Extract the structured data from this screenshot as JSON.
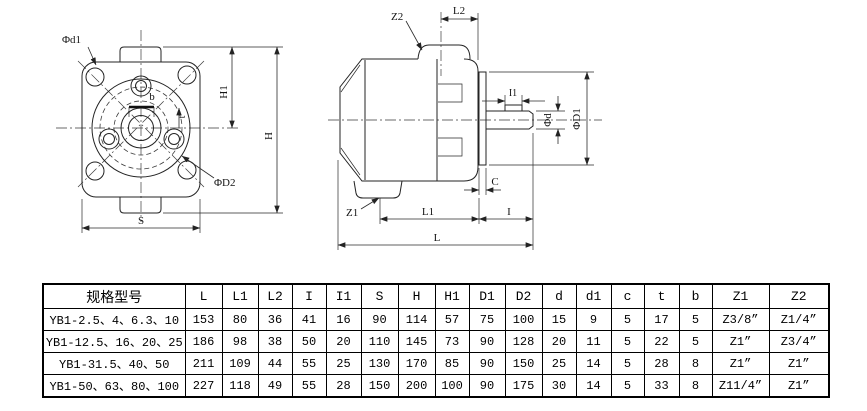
{
  "colors": {
    "line": "#232323",
    "text": "#141414",
    "table_border": "#000000",
    "background": "#ffffff"
  },
  "front_view": {
    "labels": {
      "phi_d1": "Φd1",
      "b": "b",
      "t": "t",
      "h1": "H1",
      "h": "H",
      "phi_d2": "ΦD2",
      "s": "S"
    }
  },
  "side_view": {
    "labels": {
      "z2": "Z2",
      "l2": "L2",
      "i1": "I1",
      "phi_d": "Φd",
      "phi_d1": "ΦD1",
      "c": "C",
      "z1": "Z1",
      "l1": "L1",
      "i": "I",
      "l": "L"
    }
  },
  "table": {
    "headers": [
      "规格型号",
      "L",
      "L1",
      "L2",
      "I",
      "I1",
      "S",
      "H",
      "H1",
      "D1",
      "D2",
      "d",
      "d1",
      "c",
      "t",
      "b",
      "Z1",
      "Z2"
    ],
    "rows": [
      [
        "YB1-2.5、4、6.3、10",
        "153",
        "80",
        "36",
        "41",
        "16",
        "90",
        "114",
        "57",
        "75",
        "100",
        "15",
        "9",
        "5",
        "17",
        "5",
        "Z3/8”",
        "Z1/4”"
      ],
      [
        "YB1-12.5、16、20、25",
        "186",
        "98",
        "38",
        "50",
        "20",
        "110",
        "145",
        "73",
        "90",
        "128",
        "20",
        "11",
        "5",
        "22",
        "5",
        "Z1”",
        "Z3/4”"
      ],
      [
        "YB1-31.5、40、50",
        "211",
        "109",
        "44",
        "55",
        "25",
        "130",
        "170",
        "85",
        "90",
        "150",
        "25",
        "14",
        "5",
        "28",
        "8",
        "Z1”",
        "Z1”"
      ],
      [
        "YB1-50、63、80、100",
        "227",
        "118",
        "49",
        "55",
        "28",
        "150",
        "200",
        "100",
        "90",
        "175",
        "30",
        "14",
        "5",
        "33",
        "8",
        "Z11/4”",
        "Z1”"
      ]
    ]
  }
}
